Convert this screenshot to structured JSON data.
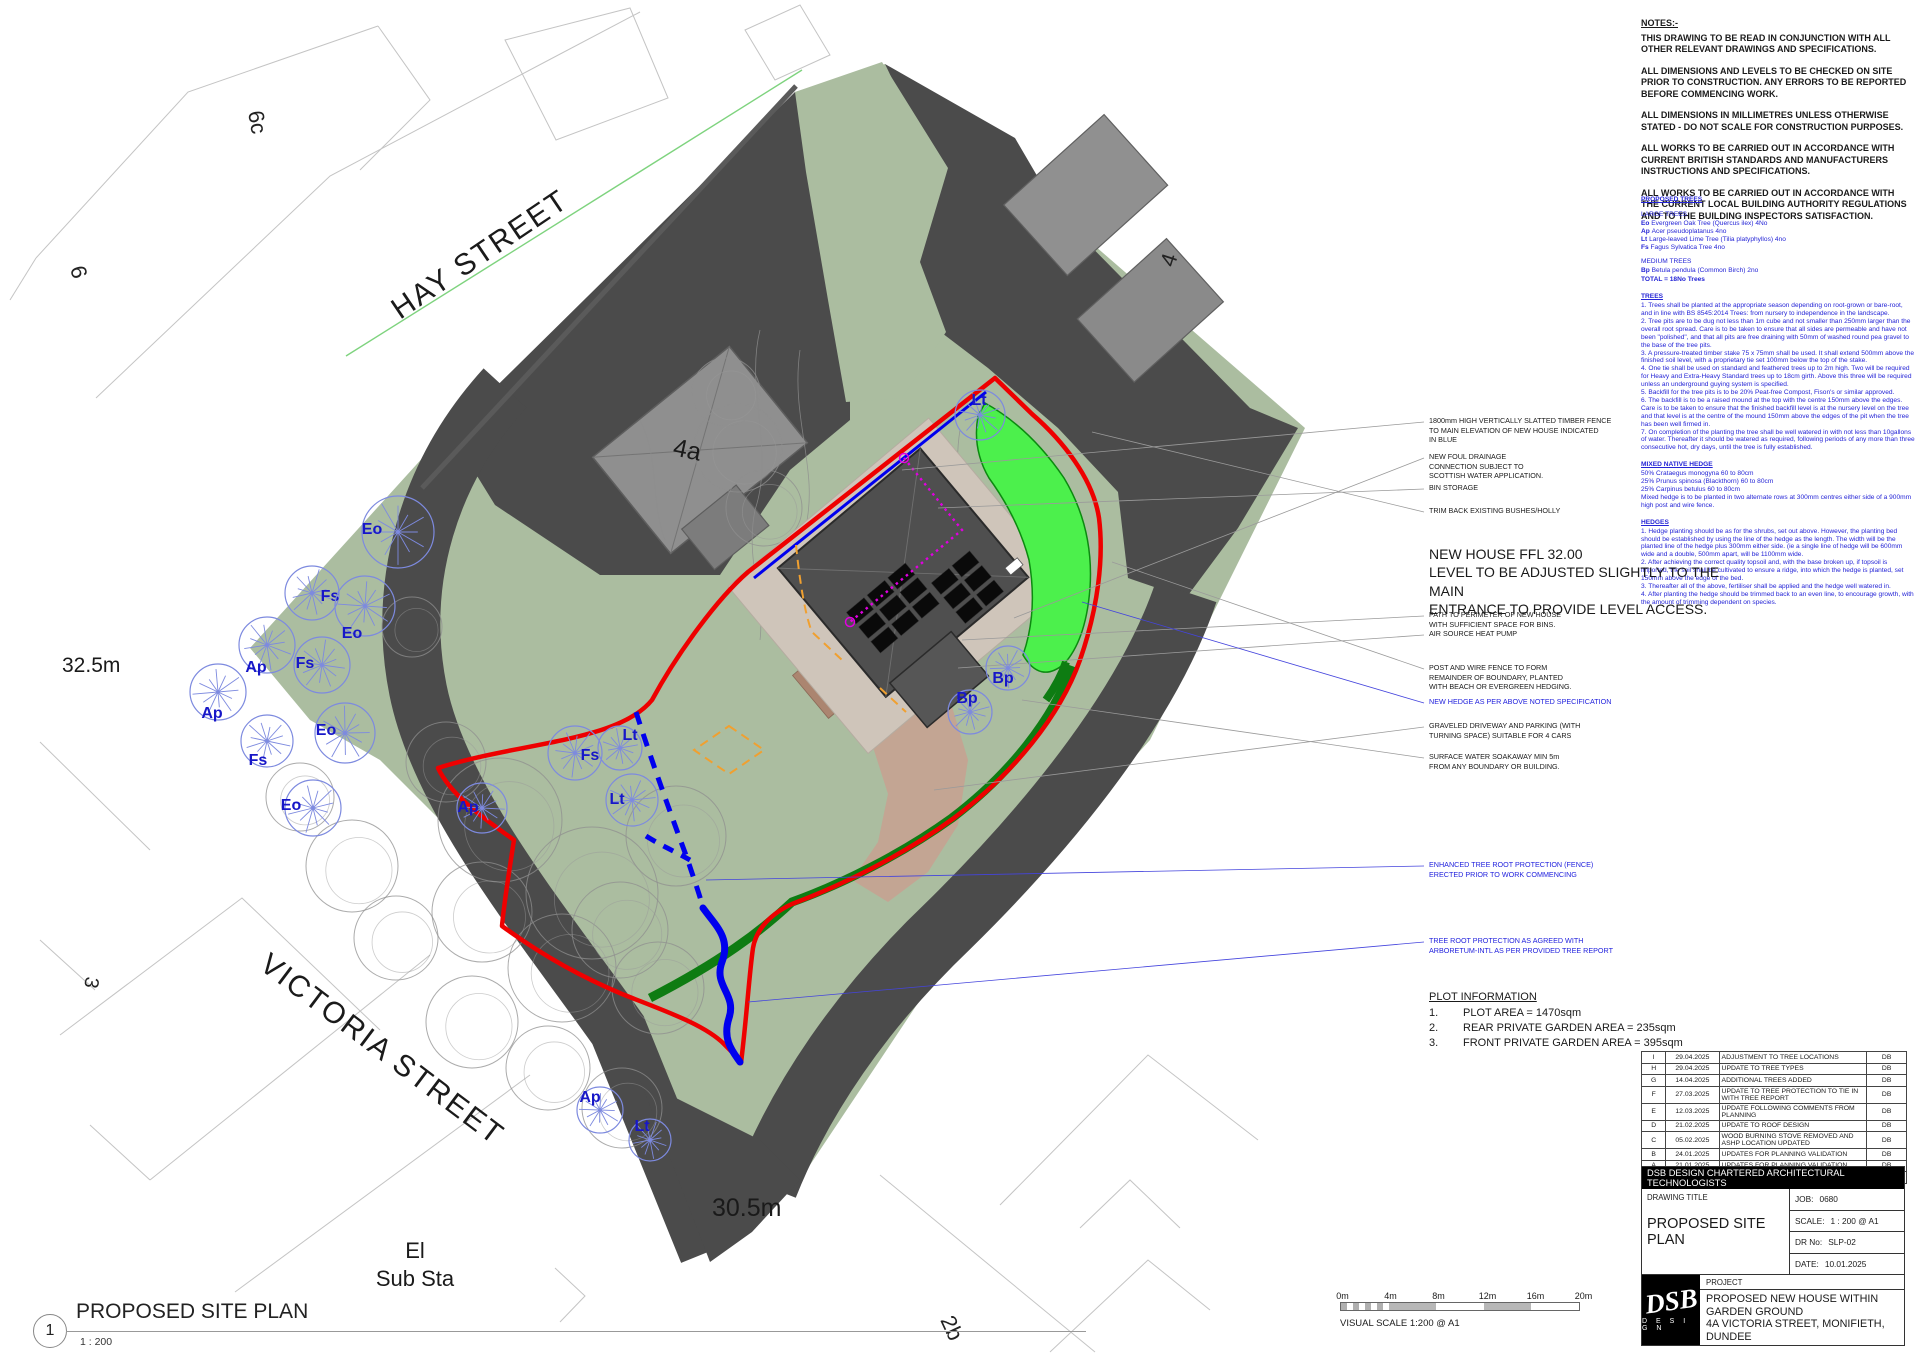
{
  "plan": {
    "street_hay": "HAY STREET",
    "street_victoria": "VICTORIA STREET",
    "level_left": "32.5m",
    "level_bottom": "30.5m",
    "substa_line1": "El",
    "substa_line2": "Sub Sta",
    "plot_6c": "6c",
    "plot_6": "6",
    "plot_4": "4",
    "plot_3": "3",
    "plot_2b": "2b",
    "plot_4a": "4a",
    "trees": [
      {
        "code": "Eo",
        "x": 398,
        "y": 532,
        "r": 36,
        "lx": 372,
        "ly": 534
      },
      {
        "code": "Fs",
        "x": 312,
        "y": 593,
        "r": 27,
        "lx": 330,
        "ly": 601
      },
      {
        "code": "Eo",
        "x": 365,
        "y": 606,
        "r": 30,
        "lx": 352,
        "ly": 638
      },
      {
        "code": "Ap",
        "x": 267,
        "y": 645,
        "r": 28,
        "lx": 256,
        "ly": 672
      },
      {
        "code": "Fs",
        "x": 322,
        "y": 665,
        "r": 28,
        "lx": 305,
        "ly": 668
      },
      {
        "code": "Ap",
        "x": 218,
        "y": 692,
        "r": 28,
        "lx": 212,
        "ly": 718
      },
      {
        "code": "Fs",
        "x": 267,
        "y": 741,
        "r": 26,
        "lx": 258,
        "ly": 765
      },
      {
        "code": "Eo",
        "x": 345,
        "y": 733,
        "r": 30,
        "lx": 326,
        "ly": 735
      },
      {
        "code": "Eo",
        "x": 313,
        "y": 808,
        "r": 28,
        "lx": 291,
        "ly": 810
      },
      {
        "code": "Ap",
        "x": 482,
        "y": 808,
        "r": 25,
        "lx": 468,
        "ly": 812
      },
      {
        "code": "Lt",
        "x": 620,
        "y": 748,
        "r": 22,
        "lx": 630,
        "ly": 740
      },
      {
        "code": "Fs",
        "x": 575,
        "y": 753,
        "r": 27,
        "lx": 590,
        "ly": 760
      },
      {
        "code": "Lt",
        "x": 632,
        "y": 800,
        "r": 26,
        "lx": 617,
        "ly": 804
      },
      {
        "code": "Lt",
        "x": 980,
        "y": 415,
        "r": 25,
        "lx": 979,
        "ly": 405
      },
      {
        "code": "Bp",
        "x": 1008,
        "y": 668,
        "r": 22,
        "lx": 1003,
        "ly": 683
      },
      {
        "code": "Bp",
        "x": 970,
        "y": 712,
        "r": 22,
        "lx": 967,
        "ly": 703
      },
      {
        "code": "Ap",
        "x": 600,
        "y": 1110,
        "r": 23,
        "lx": 590,
        "ly": 1102
      },
      {
        "code": "Lt",
        "x": 650,
        "y": 1140,
        "r": 21,
        "lx": 642,
        "ly": 1131
      }
    ]
  },
  "notes": {
    "title": "NOTES:-",
    "paragraphs": [
      "THIS DRAWING TO BE READ IN CONJUNCTION WITH ALL OTHER RELEVANT DRAWINGS AND SPECIFICATIONS.",
      "ALL DIMENSIONS AND LEVELS TO BE CHECKED ON SITE PRIOR TO CONSTRUCTION. ANY ERRORS TO BE REPORTED  BEFORE COMMENCING WORK.",
      "ALL DIMENSIONS IN MILLIMETRES UNLESS OTHERWISE STATED - DO NOT SCALE FOR CONSTRUCTION PURPOSES.",
      "ALL WORKS TO BE CARRIED OUT IN ACCORDANCE WITH CURRENT BRITISH STANDARDS AND MANUFACTURERS INSTRUCTIONS AND SPECIFICATIONS.",
      "ALL WORKS TO BE CARRIED OUT IN ACCORDANCE WITH THE CURRENT LOCAL BUILDING AUTHORITY REGULATIONS AND TO THE BUILDING INSPECTORS SATISFACTION."
    ]
  },
  "specs": {
    "title": "PROPOSED TREES",
    "large_title": "LARGE TREES",
    "large": [
      {
        "code": "Eo",
        "desc": "Evergreen Oak Tree (Quercus ilex) 4No"
      },
      {
        "code": "Ap",
        "desc": "Acer pseudoplatanus 4no"
      },
      {
        "code": "Lt",
        "desc": "Large-leaved Lime Tree (Tilia platyphyllos) 4no"
      },
      {
        "code": "Fs",
        "desc": "Fagus Sylvatica Tree 4no"
      }
    ],
    "medium_title": "MEDIUM TREES",
    "medium": [
      {
        "code": "Bp",
        "desc": "Betula pendula (Common Birch) 2no"
      }
    ],
    "total": "TOTAL = 18No Trees",
    "sections": [
      {
        "title": "TREES",
        "lines": [
          "1. Trees shall be planted at the appropriate season depending on root-grown or bare-root, and in line with BS 8545:2014 Trees: from nursery to independence in the landscape.",
          "2. Tree pits are to be dug not less than 1m cube and not smaller than 250mm larger than the overall root spread. Care is to be taken to ensure that all sides are permeable and have not been \"polished\", and that all pits are free draining with 50mm of washed round pea gravel to the base of the tree pits.",
          "3. A pressure-treated timber stake 75 x 75mm shall be used. It shall extend 500mm above the finished soil level, with a proprietary tie set 100mm below the top of the stake.",
          "4. One tie shall be used on standard and feathered trees up to 2m high. Two will be required for Heavy and Extra-Heavy Standard trees up to 18cm girth. Above this three will be required unless an underground guying system is specified.",
          "5. Backfill for the tree pits is to be 20% Peat-free Compost, Fison's or similar approved.",
          "6. The backfill is to be a raised mound at the top with the centre 150mm above the edges. Care is to be taken to ensure that the finished backfill level is at the nursery level on the tree and that level is at the centre of the mound 150mm above the edges of the pit when the tree has been well firmed in.",
          "7. On completion of the planting the tree shall be well watered in with not less than 10gallons of water. Thereafter it should be watered as required, following periods of any more than three consecutive hot, dry days, until the tree is fully established."
        ]
      },
      {
        "title": "MIXED NATIVE HEDGE",
        "lines": [
          "50% Crataegus monogyna 60 to 80cm",
          "25% Prunus spinosa (Blackthorn) 60 to 80cm",
          "25% Carpinus betulus 60 to 80cm",
          "Mixed hedge is to be planted in two alternate rows at 300mm centres either side of a 900mm high post and wire fence."
        ]
      },
      {
        "title": "HEDGES",
        "lines": [
          "1. Hedge planting should be as for the shrubs, set out above. However, the planting bed should be established by using the line of the hedge as the length. The width will be the planted line of the hedge plus 300mm either side. (ie a single line of hedge will be 600mm wide and a double, 500mm apart, will be 1100mm wide.",
          "2. After achieving the correct quality topsoil and, with the base broken up, if topsoil is imported, the soil shall be cultivated to ensure a ridge, into which the hedge is planted, set 150mm above the edge of the bed.",
          "3. Thereafter all of the above, fertiliser shall be applied and the hedge well watered in.",
          "4. After planting the hedge should be trimmed back to an even line, to encourage growth, with the amount of trimming dependent on species."
        ]
      }
    ]
  },
  "annotations": [
    {
      "text": "1800mm HIGH VERTICALLY SLATTED TIMBER FENCE\nTO MAIN ELEVATION OF NEW HOUSE INDICATED\nIN BLUE",
      "color": "black",
      "top": 416,
      "lx": 902,
      "ly": 470
    },
    {
      "text": "NEW FOUL DRAINAGE\nCONNECTION SUBJECT TO\nSCOTTISH WATER APPLICATION.",
      "color": "black",
      "top": 452,
      "lx": 1014,
      "ly": 618
    },
    {
      "text": "BIN STORAGE",
      "color": "black",
      "top": 483,
      "lx": 938,
      "ly": 508
    },
    {
      "text": "TRIM BACK EXISTING BUSHES/HOLLY",
      "color": "black",
      "top": 506,
      "lx": 1092,
      "ly": 432
    },
    {
      "text": "PATH TO PERIMETER OF NEW HOUSE\nWITH SUFFICIENT SPACE FOR BINS.",
      "color": "black",
      "top": 610,
      "lx": 962,
      "ly": 640
    },
    {
      "text": "AIR SOURCE HEAT PUMP",
      "color": "black",
      "top": 629,
      "lx": 958,
      "ly": 668
    },
    {
      "text": "POST AND WIRE FENCE TO FORM\nREMAINDER OF BOUNDARY, PLANTED\nWITH BEACH OR EVERGREEN HEDGING.",
      "color": "black",
      "top": 663,
      "lx": 1112,
      "ly": 562
    },
    {
      "text": "NEW HEDGE AS PER ABOVE NOTED SPECIFICATION",
      "color": "blue",
      "top": 697,
      "lx": 1082,
      "ly": 602
    },
    {
      "text": "GRAVELED DRIVEWAY AND PARKING (WITH\nTURNING SPACE) SUITABLE FOR 4 CARS",
      "color": "black",
      "top": 721,
      "lx": 934,
      "ly": 790
    },
    {
      "text": "SURFACE WATER SOAKAWAY MIN 5m\nFROM ANY BOUNDARY OR BUILDING.",
      "color": "black",
      "top": 752,
      "lx": 1022,
      "ly": 700
    },
    {
      "text": "ENHANCED TREE ROOT PROTECTION (FENCE)\nERECTED PRIOR TO WORK COMMENCING",
      "color": "blue",
      "top": 860,
      "lx": 706,
      "ly": 880
    },
    {
      "text": "TREE ROOT PROTECTION AS AGREED WITH\nARBORETUM-INTL AS PER PROVIDED TREE REPORT",
      "color": "blue",
      "top": 936,
      "lx": 748,
      "ly": 1002
    }
  ],
  "ffl": {
    "line1": "NEW HOUSE FFL 32.00",
    "line2": "LEVEL TO BE ADJUSTED SLIGHTLY TO THE MAIN\nENTRANCE TO PROVIDE LEVEL ACCESS."
  },
  "plot_info": {
    "title": "PLOT INFORMATION",
    "items": [
      {
        "num": "1.",
        "text": "PLOT AREA = 1470sqm"
      },
      {
        "num": "2.",
        "text": "REAR PRIVATE GARDEN AREA = 235sqm"
      },
      {
        "num": "3.",
        "text": "FRONT PRIVATE GARDEN AREA = 395sqm"
      }
    ]
  },
  "revisions": {
    "rows": [
      [
        "I",
        "29.04.2025",
        "ADJUSTMENT TO TREE LOCATIONS",
        "DB"
      ],
      [
        "H",
        "29.04.2025",
        "UPDATE TO TREE TYPES",
        "DB"
      ],
      [
        "G",
        "14.04.2025",
        "ADDITIONAL TREES ADDED",
        "DB"
      ],
      [
        "F",
        "27.03.2025",
        "UPDATE TO TREE PROTECTION TO TIE IN WITH TREE REPORT",
        "DB"
      ],
      [
        "E",
        "12.03.2025",
        "UPDATE FOLLOWING COMMENTS FROM PLANNING",
        "DB"
      ],
      [
        "D",
        "21.02.2025",
        "UPDATE TO ROOF DESIGN",
        "DB"
      ],
      [
        "C",
        "05.02.2025",
        "WOOD BURNING STOVE REMOVED AND ASHP LOCATION UPDATED",
        "DB"
      ],
      [
        "B",
        "24.01.2025",
        "UPDATES FOR PLANNING VALIDATION",
        "DB"
      ],
      [
        "A",
        "21.01.2025",
        "UPDATES FOR PLANNING VALIDATION",
        "DB"
      ]
    ],
    "columns": [
      "Rev",
      "Date",
      "Description",
      "Initials"
    ]
  },
  "title_block": {
    "company": "DSB DESIGN CHARTERED ARCHITECTURAL TECHNOLOGISTS",
    "drawing_title_label": "DRAWING TITLE",
    "drawing_title": "PROPOSED SITE PLAN",
    "job_label": "JOB:",
    "job": "0680",
    "scale_label": "SCALE:",
    "scale": "1 : 200  @  A1",
    "drno_label": "DR No:",
    "drno": "SLP-02",
    "date_label": "DATE:",
    "date": "10.01.2025",
    "logo_dsb": "DSB",
    "logo_design": "D E S I G N",
    "project_label": "PROJECT",
    "project_lines": [
      "PROPOSED NEW HOUSE WITHIN",
      "GARDEN GROUND",
      "4A VICTORIA STREET, MONIFIETH,",
      "DUNDEE"
    ]
  },
  "scale_bar": {
    "labels": [
      "0m",
      "4m",
      "8m",
      "12m",
      "16m",
      "20m"
    ],
    "caption": "VISUAL SCALE 1:200  @ A1"
  },
  "view_label": {
    "number": "1",
    "title": "PROPOSED SITE PLAN",
    "scale": "1 : 200"
  },
  "colors": {
    "site_green": "#abbda0",
    "surround_gray": "#4b4b4b",
    "new_hedge_green": "#4cf04c",
    "hedge_strip_green": "#0e7c12",
    "boundary_red": "#ee0000",
    "fence_blue": "#0000ee",
    "marker_magenta": "#e000e0",
    "setback_orange": "#f0a030",
    "tree_blue": "#7d8adf",
    "tree_label_blue": "#1717c8"
  }
}
